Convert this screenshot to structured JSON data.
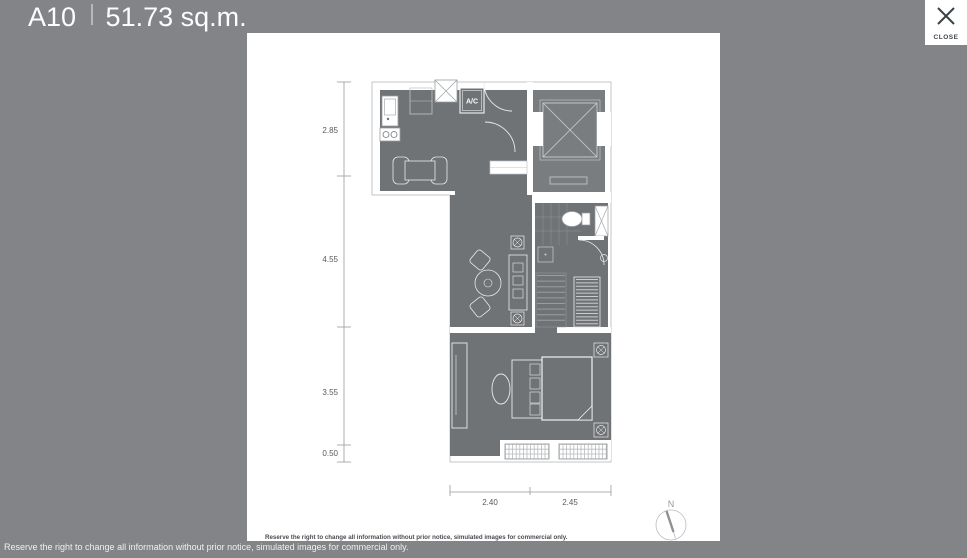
{
  "header": {
    "unit": "A10",
    "area": "51.73 sq.m."
  },
  "close_button": {
    "label": "CLOSE"
  },
  "floorplan": {
    "ac_label": "A/C",
    "vertical_dimensions": [
      "2.85",
      "4.55",
      "3.55",
      "0.50"
    ],
    "horizontal_dimensions": [
      "2.40",
      "2.45"
    ],
    "compass_label": "N",
    "disclaimer": "Reserve the right to change all information without prior notice, simulated images for commercial only."
  },
  "footer": {
    "disclaimer": "Reserve the right to change all information without prior notice, simulated images for commercial only."
  },
  "colors": {
    "background": "#828488",
    "panel": "#ffffff",
    "plan_room_fill": "#707376",
    "header_text": "#fcfdfd",
    "close_text": "#41474d",
    "dimension_text": "#58595c"
  }
}
